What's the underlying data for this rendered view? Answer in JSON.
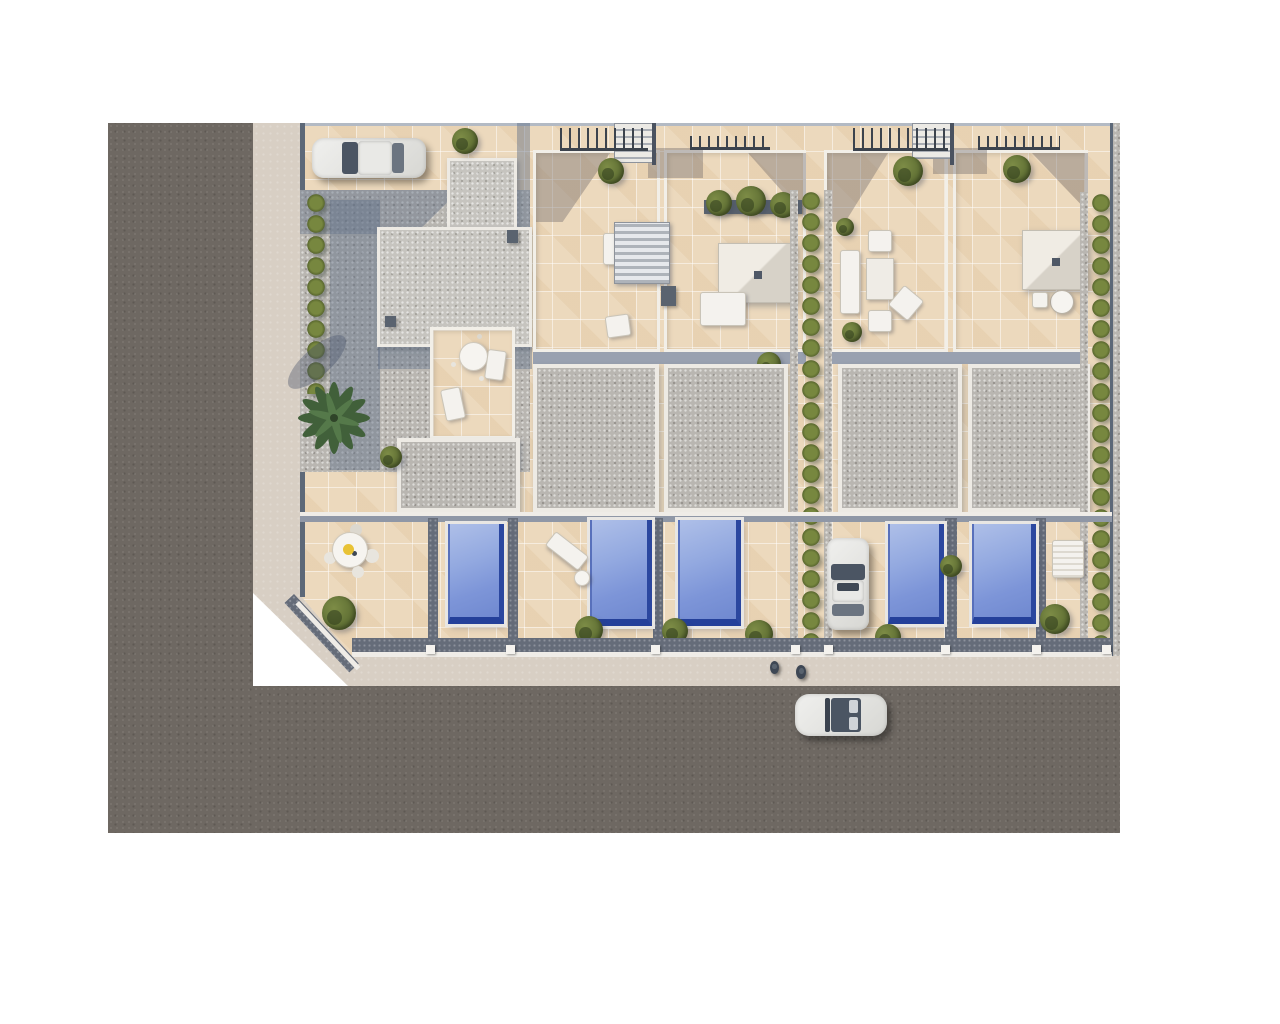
{
  "scene": {
    "description": "Aerial 3D architectural render of a residential development: six attached townhouses with beige-tiled rooftop terraces, gray gravel flat roofs, private gardens with five blue swimming pools, olive-green hedges, one palm tree, three white cars and two pedestrians, bordered by an L-shaped dark asphalt road with a light sidewalk on a white background",
    "objects": {
      "townhouses": 6,
      "rooftop_terraces": 5,
      "swimming_pools": 5,
      "cars": 3,
      "pedestrians": 2,
      "palm_trees": 1,
      "hedge_rows": 3,
      "stair_railings": 4,
      "outdoor_tables": 3,
      "sun_loungers": 4
    }
  },
  "colors": {
    "background": "#ffffff",
    "road": "#6e6862",
    "sidewalk": "#d8cfc4",
    "tile": "#ecd9bd",
    "gravel": "#b9b6b1",
    "roof_frame": "#edeae4",
    "wall": "#5c6878",
    "shadow": "#98a0af",
    "hedge": "#6d7c3e",
    "pool_light": "#aebfe8",
    "pool_dark": "#2b479f",
    "furniture": "#f4f2ee",
    "umbrella": "#e8c235"
  }
}
